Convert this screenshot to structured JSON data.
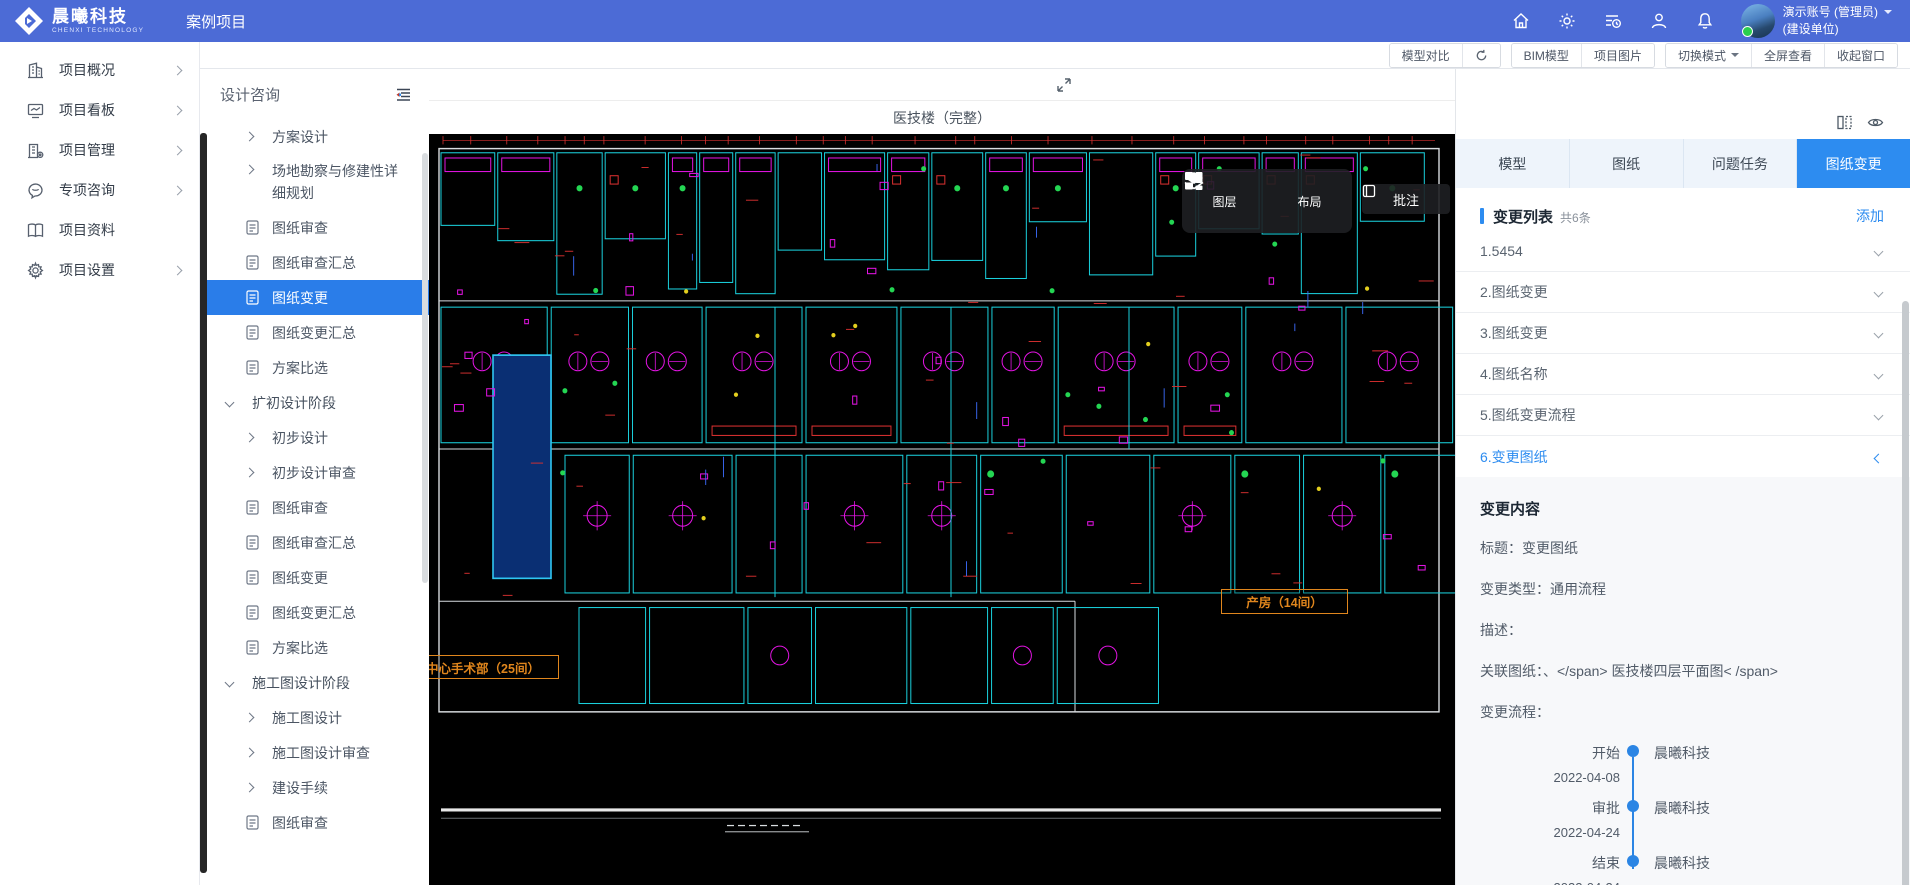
{
  "header": {
    "brand_name": "晨曦科技",
    "brand_sub": "CHENXI TECHNOLOGY",
    "page_title": "案例项目",
    "user_name": "演示账号 (管理员)",
    "user_org": "(建设单位)"
  },
  "toolbar": {
    "compare": "模型对比",
    "bim": "BIM模型",
    "photos": "项目图片",
    "mode": "切换模式",
    "fullscreen": "全屏查看",
    "collapse": "收起窗口"
  },
  "sidebar": {
    "items": [
      {
        "label": "项目概况"
      },
      {
        "label": "项目看板"
      },
      {
        "label": "项目管理"
      },
      {
        "label": "专项咨询"
      },
      {
        "label": "项目资料"
      },
      {
        "label": "项目设置"
      }
    ]
  },
  "tree": {
    "title": "设计咨询",
    "items": [
      {
        "label": "方案设计"
      },
      {
        "label": "场地勘察与修建性详细规划"
      },
      {
        "label": "图纸审查"
      },
      {
        "label": "图纸审查汇总"
      },
      {
        "label": "图纸变更"
      },
      {
        "label": "图纸变更汇总"
      },
      {
        "label": "方案比选"
      },
      {
        "label": "扩初设计阶段"
      },
      {
        "label": "初步设计"
      },
      {
        "label": "初步设计审查"
      },
      {
        "label": "图纸审查"
      },
      {
        "label": "图纸审查汇总"
      },
      {
        "label": "图纸变更"
      },
      {
        "label": "图纸变更汇总"
      },
      {
        "label": "方案比选"
      },
      {
        "label": "施工图设计阶段"
      },
      {
        "label": "施工图设计"
      },
      {
        "label": "施工图设计审查"
      },
      {
        "label": "建设手续"
      },
      {
        "label": "图纸审查"
      }
    ]
  },
  "viewer": {
    "title": "医技楼（完整）",
    "layers": "图层",
    "layout": "布局",
    "annotate": "批注",
    "cad_labels": {
      "ward": "产房（14间）",
      "surgery": "中心手术部（25间）"
    }
  },
  "tabs": {
    "t0": "模型",
    "t1": "图纸",
    "t2": "问题任务",
    "t3": "图纸变更"
  },
  "changes": {
    "title": "变更列表",
    "count": "共6条",
    "add": "添加",
    "items": [
      {
        "label": "1.5454"
      },
      {
        "label": "2.图纸变更"
      },
      {
        "label": "3.图纸变更"
      },
      {
        "label": "4.图纸名称"
      },
      {
        "label": "5.图纸变更流程"
      },
      {
        "label": "6.变更图纸"
      }
    ]
  },
  "detail": {
    "heading": "变更内容",
    "f0l": "标题：",
    "f0v": "变更图纸",
    "f1l": "变更类型：",
    "f1v": "通用流程",
    "f2l": "描述：",
    "f2v": "",
    "f3l": "关联图纸：",
    "f3v": "、</span> 医技楼四层平面图< /span>",
    "f4l": "变更流程：",
    "f4v": "",
    "timeline": [
      {
        "stage": "开始",
        "date": "2022-04-08",
        "actor": "晨曦科技"
      },
      {
        "stage": "审批",
        "date": "2022-04-24",
        "actor": "晨曦科技"
      },
      {
        "stage": "结束",
        "date": "2022-04-24",
        "actor": "晨曦科技"
      }
    ]
  },
  "icons": {
    "header": [
      "home-icon",
      "gear-icon",
      "audit-log-icon",
      "user-icon",
      "bell-icon"
    ],
    "viewer": [
      "layers-icon",
      "grid-layout-icon",
      "annotate-icon",
      "collapse-arrows-icon"
    ],
    "right_panel": [
      "columns-icon",
      "eye-icon"
    ]
  },
  "colors": {
    "header_blue": "#4c6bd6",
    "primary_blue": "#2d8cf0",
    "tree_selected": "#2a7de9",
    "cad_orange": "#e0861d",
    "timeline_blue": "#2b85e4"
  }
}
